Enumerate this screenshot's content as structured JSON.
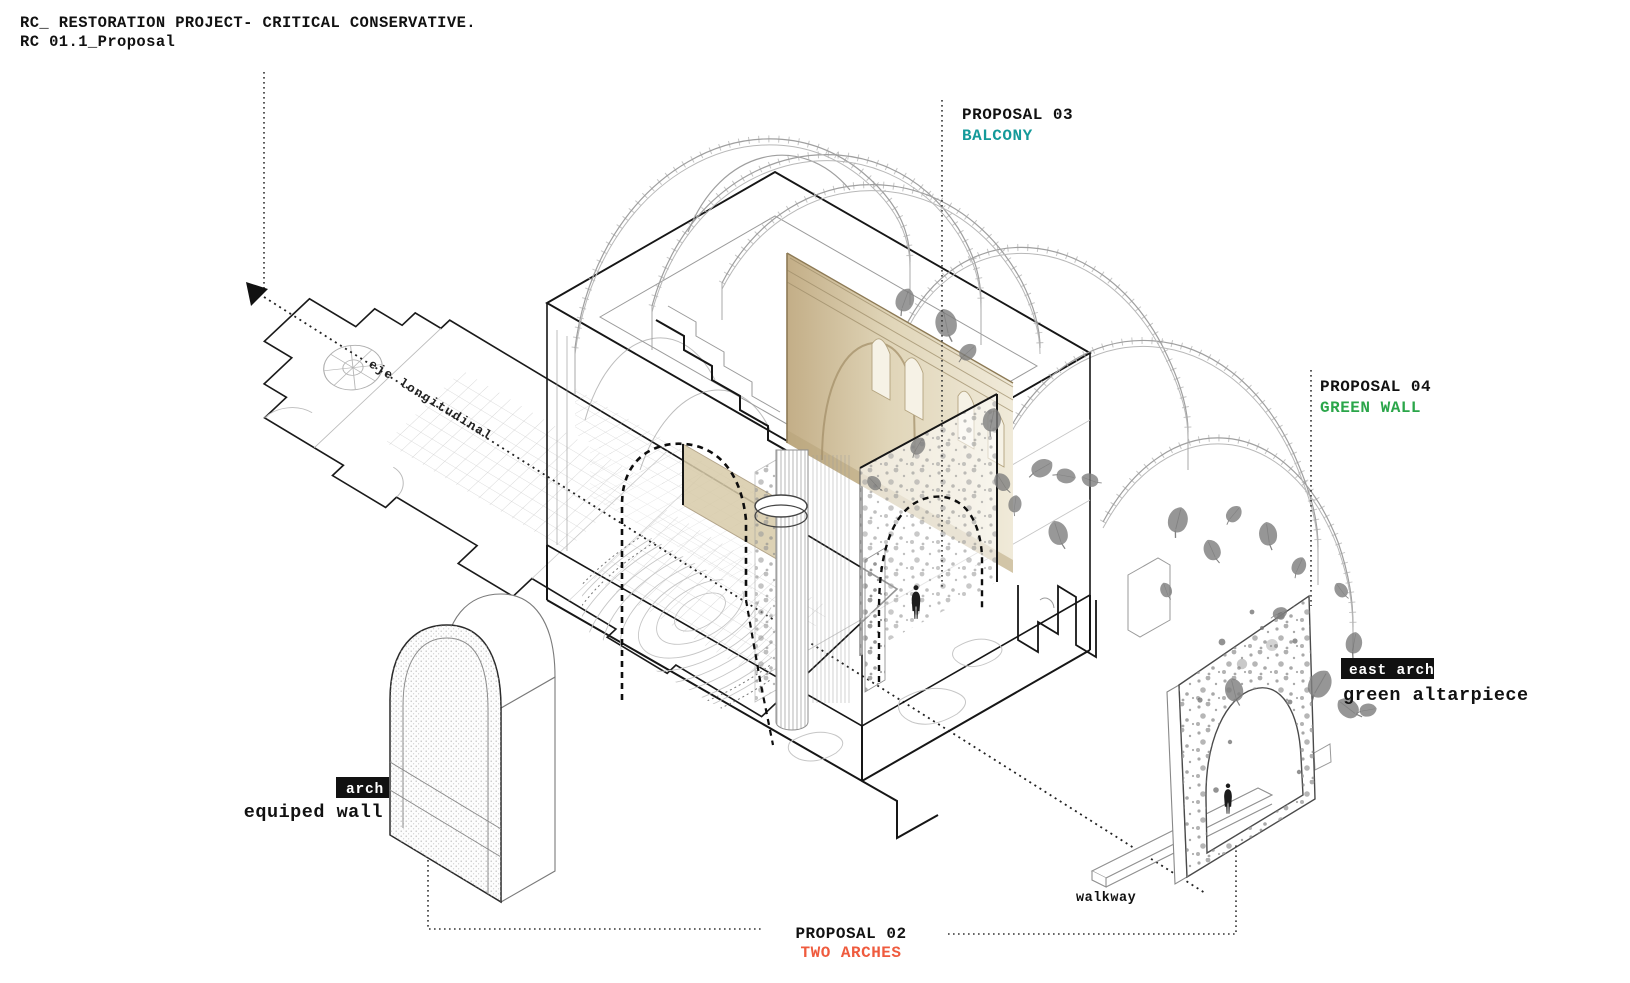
{
  "title": {
    "line1": "RC_ RESTORATION PROJECT- CRITICAL CONSERVATIVE.",
    "line2": "RC 01.1_Proposal"
  },
  "annotations": {
    "proposal02": {
      "title": "PROPOSAL 02",
      "subtitle": "TWO ARCHES",
      "subtitle_color": "#ef5b3e"
    },
    "proposal03": {
      "title": "PROPOSAL 03",
      "subtitle": "BALCONY",
      "subtitle_color": "#149a9a"
    },
    "proposal04": {
      "title": "PROPOSAL 04",
      "subtitle": "GREEN WALL",
      "subtitle_color": "#2ba64a"
    },
    "east_arch": {
      "tag": "east arch",
      "caption": "green altarpiece"
    },
    "equipped_wall": {
      "tag": "arch",
      "caption": "equiped wall"
    },
    "walkway_label": "walkway",
    "axis_label": "eje longitudinal"
  },
  "colors": {
    "ink": "#111111",
    "line_gray": "#9a9a9a",
    "leaf_gray": "#7f7f7f",
    "tan_wall": "#d9cba6",
    "teal": "#149a9a",
    "green": "#2ba64a",
    "red_orange": "#ef5b3e"
  }
}
